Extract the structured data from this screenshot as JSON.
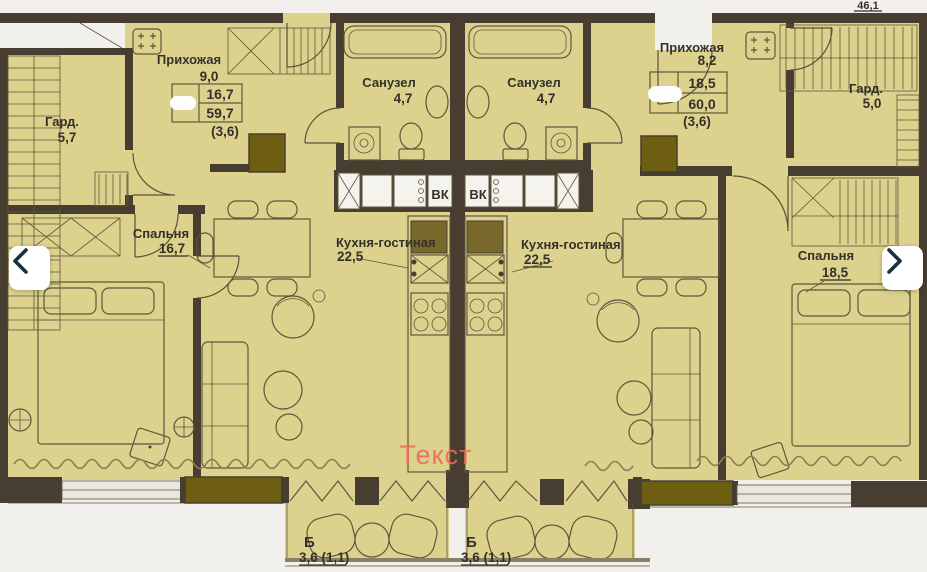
{
  "colors": {
    "paper": "#f2f0ec",
    "floor": "#dcd28e",
    "wall": "#473e31",
    "olive": "#6e5e12",
    "ink": "#34302a",
    "watermark": "#f0685e",
    "chevron": "#16323f"
  },
  "viewer": {
    "prev_icon": "chevron-left-icon",
    "next_icon": "chevron-right-icon"
  },
  "plan": {
    "corner_total": "46,1",
    "watermark": "Текст",
    "shaft_left": "ВК",
    "shaft_right": "ВК",
    "apartment_left": {
      "hallway": {
        "name": "Прихожая",
        "area": "9,0"
      },
      "area_table": {
        "living": "16,7",
        "total": "59,7",
        "note": "(3,6)"
      },
      "wardrobe": {
        "name": "Гард.",
        "area": "5,7"
      },
      "bathroom": {
        "name": "Санузел",
        "area": "4,7"
      },
      "bedroom": {
        "name": "Спальня",
        "area": "16,7"
      },
      "kitchen_living": {
        "name": "Кухня-гостиная",
        "area": "22,5"
      },
      "balcony": {
        "name": "Б",
        "area": "3,6 (1,1)"
      }
    },
    "apartment_right": {
      "hallway": {
        "name": "Прихожая",
        "area": "8,2"
      },
      "area_table": {
        "living": "18,5",
        "total": "60,0",
        "note": "(3,6)"
      },
      "wardrobe": {
        "name": "Гард.",
        "area": "5,0"
      },
      "bathroom": {
        "name": "Санузел",
        "area": "4,7"
      },
      "bedroom": {
        "name": "Спальня",
        "area": "18,5"
      },
      "kitchen_living": {
        "name": "Кухня-гостиная",
        "area": "22,5"
      },
      "balcony": {
        "name": "Б",
        "area": "3,6 (1,1)"
      }
    }
  }
}
